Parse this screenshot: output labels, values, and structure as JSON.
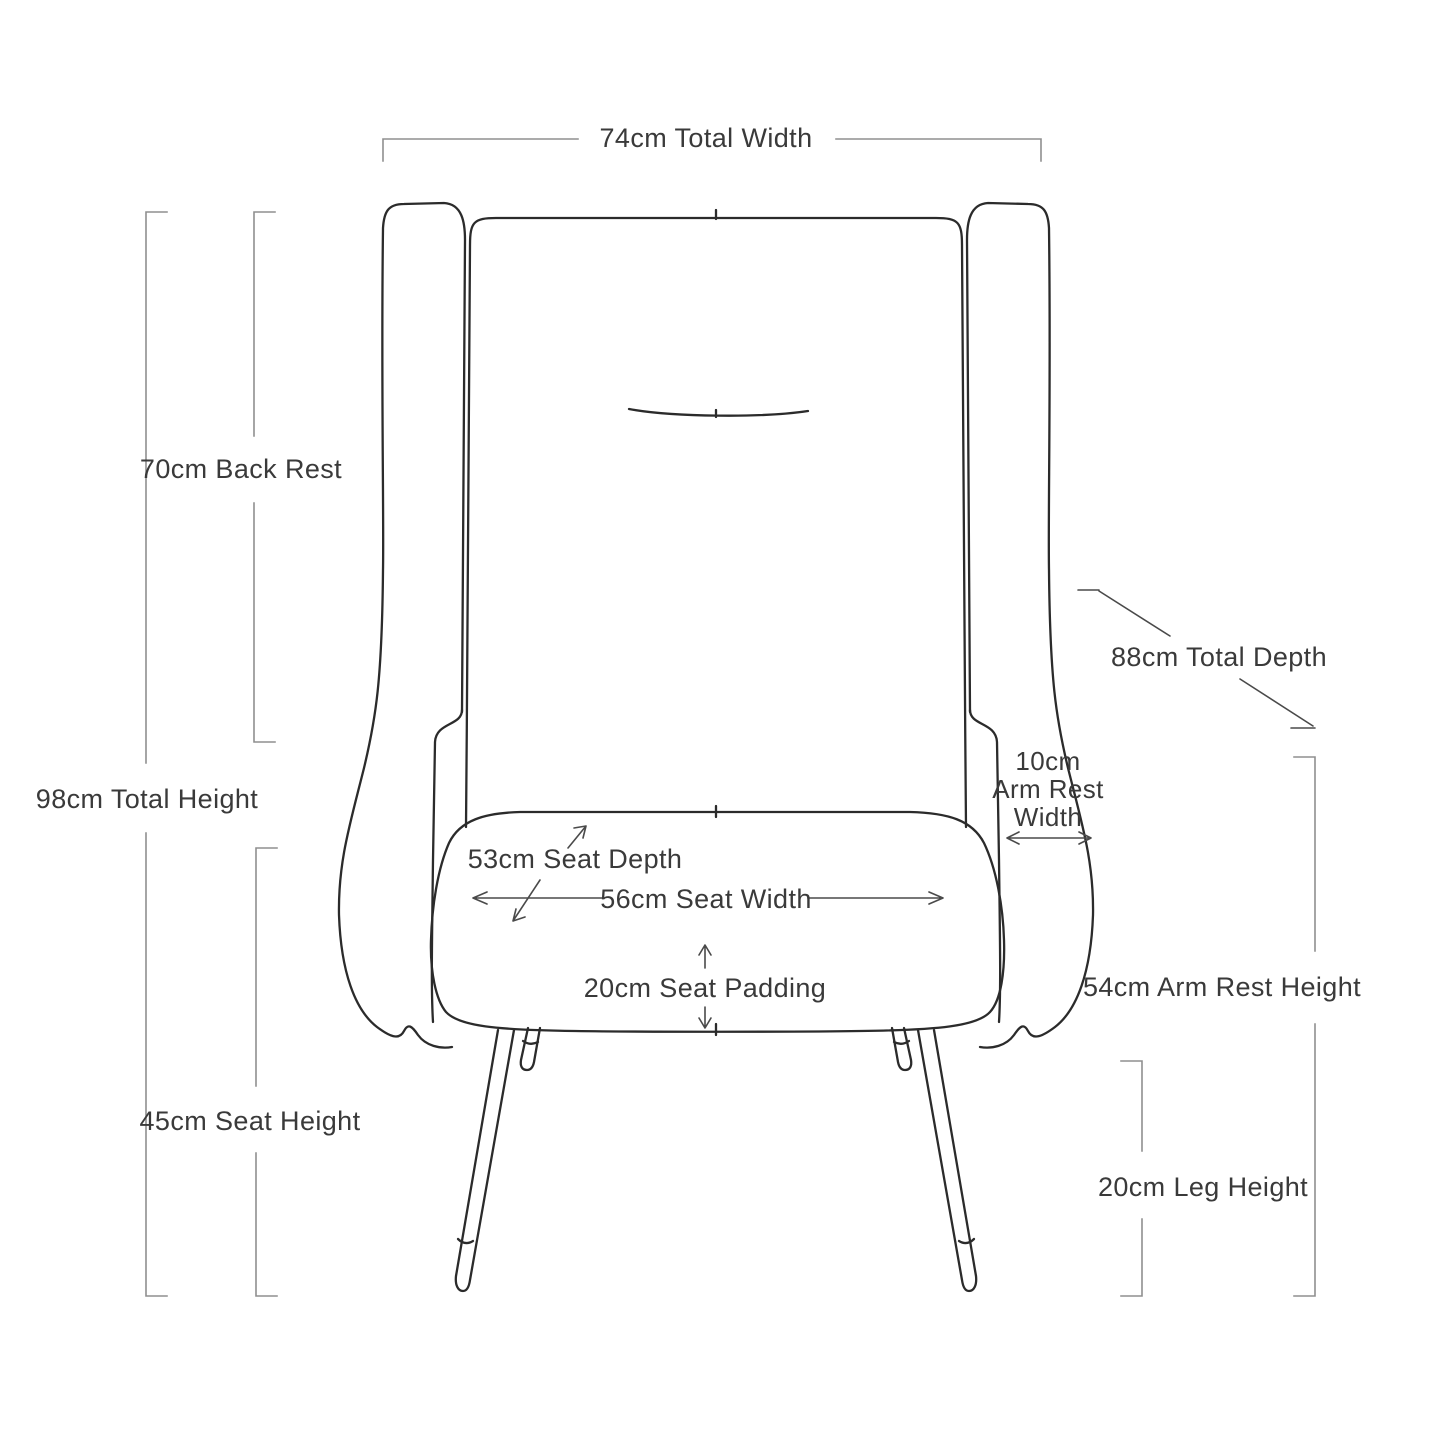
{
  "colors": {
    "background": "#ffffff",
    "chair_line": "#2b2b2b",
    "bracket_line": "#8f8f8f",
    "arrow_line": "#4a4a4a",
    "text": "#3a3a3a"
  },
  "dimensions": {
    "total_width": {
      "label": "74cm Total Width"
    },
    "back_rest": {
      "label": "70cm Back Rest"
    },
    "total_height": {
      "label": "98cm Total Height"
    },
    "seat_height": {
      "label": "45cm Seat Height"
    },
    "total_depth": {
      "label": "88cm Total Depth"
    },
    "arm_rest_width": {
      "lines": [
        "10cm",
        "Arm Rest",
        "Width"
      ]
    },
    "arm_rest_height": {
      "label": "54cm Arm Rest Height"
    },
    "leg_height": {
      "label": "20cm Leg Height"
    },
    "seat_depth": {
      "label": "53cm Seat Depth"
    },
    "seat_width": {
      "label": "56cm Seat Width"
    },
    "seat_padding": {
      "label": "20cm Seat Padding"
    }
  }
}
